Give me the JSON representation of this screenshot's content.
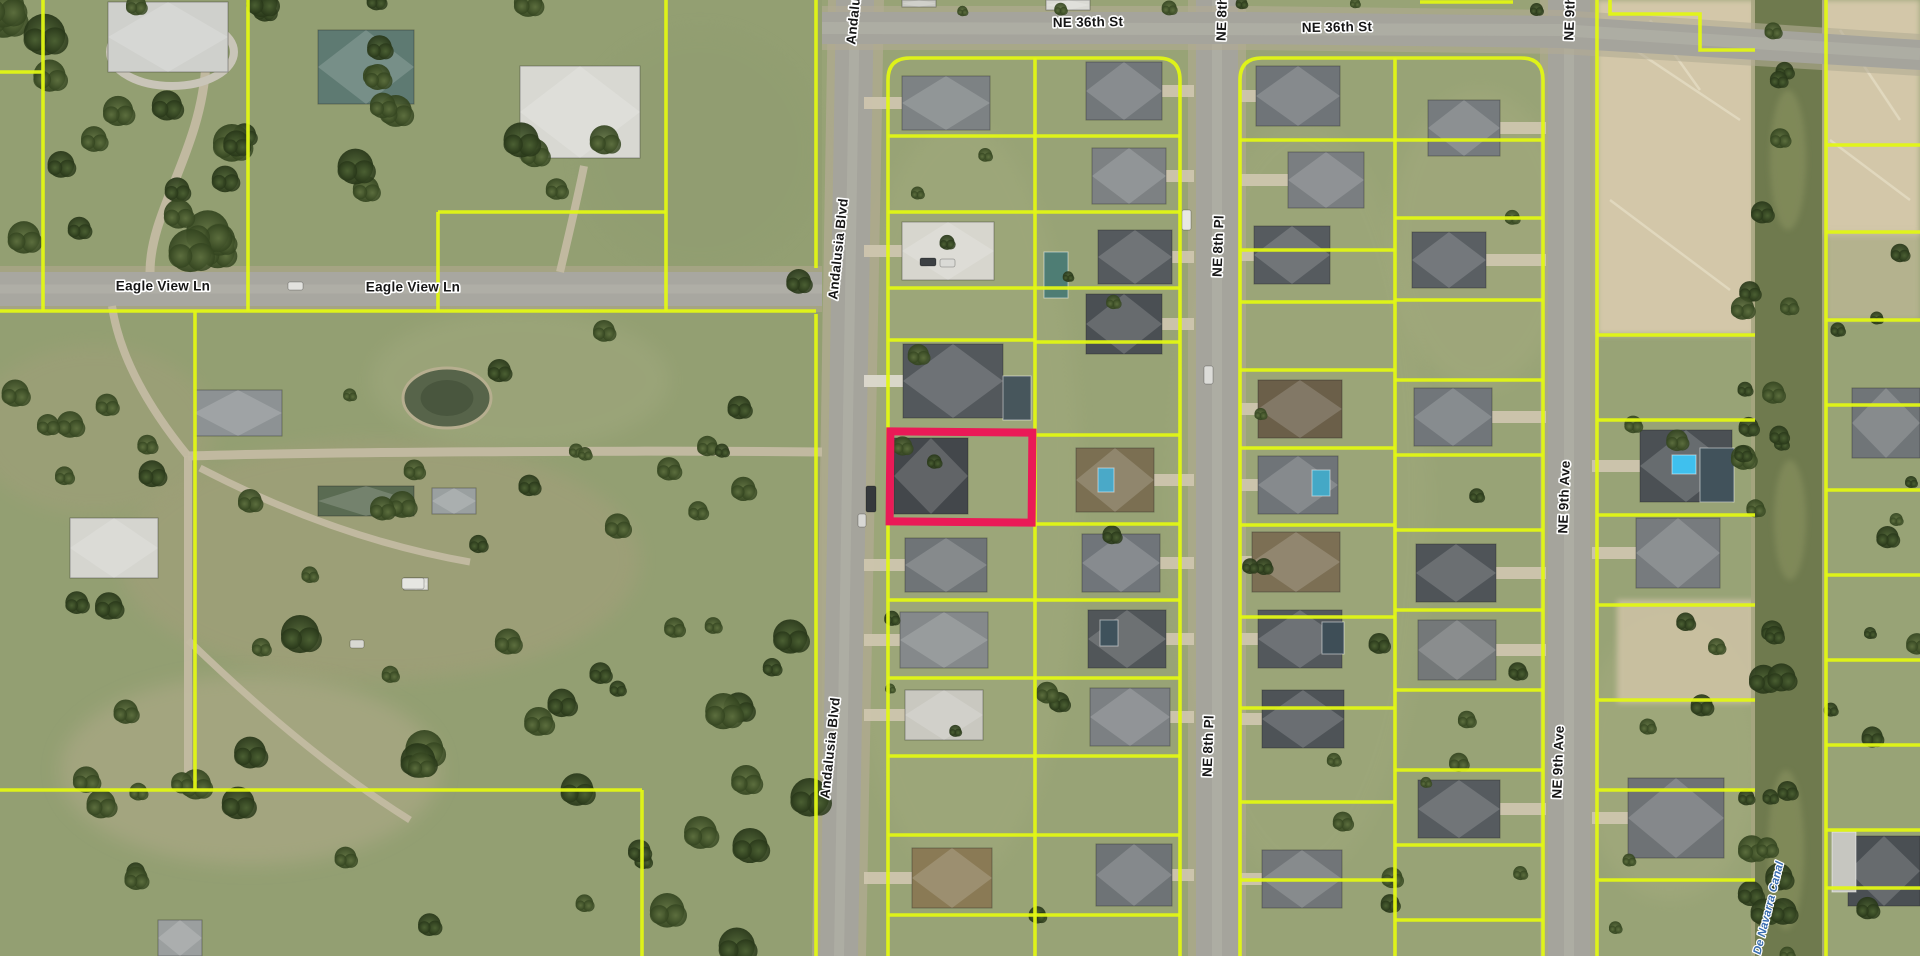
{
  "map": {
    "width": 1920,
    "height": 956,
    "colors": {
      "grass": "#98a376",
      "grass_west_overlay": "#89986b",
      "asphalt": "#a5a49c",
      "asphalt_wear": "#b8b7ae",
      "shoulder": "#b3ab94",
      "dirt": "#d3c7a9",
      "dirt_streak": "#e7dfc8",
      "parcel_line": "#e1f714",
      "highlight": "#ea1a57",
      "water": "#6f7a4e",
      "water_light": "#8a9361",
      "pond": "#57644a",
      "label_fill": "#151515",
      "label_halo": "#ffffff",
      "canal_label_fill": "#3a6db0",
      "driveway": "#c3bba2"
    },
    "street_labels": [
      {
        "text": "Andalusia Blvd",
        "x": 857,
        "y": -6,
        "rot": -84
      },
      {
        "text": "NE 36th St",
        "x": 1088,
        "y": 23,
        "rot": -1
      },
      {
        "text": "NE 8th Pl",
        "x": 1223,
        "y": 10,
        "rot": -88
      },
      {
        "text": "NE 36th St",
        "x": 1337,
        "y": 28,
        "rot": -1
      },
      {
        "text": "NE 9th Ave",
        "x": 1571,
        "y": 4,
        "rot": -88
      },
      {
        "text": "Eagle View Ln",
        "x": 163,
        "y": 287,
        "rot": 0
      },
      {
        "text": "Eagle View Ln",
        "x": 413,
        "y": 288,
        "rot": 0
      },
      {
        "text": "Andalusia Blvd",
        "x": 839,
        "y": 249,
        "rot": -84
      },
      {
        "text": "NE 8th Pl",
        "x": 1219,
        "y": 246,
        "rot": -88
      },
      {
        "text": "NE 9th Ave",
        "x": 1565,
        "y": 497,
        "rot": -88
      },
      {
        "text": "Andalusia Blvd",
        "x": 831,
        "y": 748,
        "rot": -84
      },
      {
        "text": "NE 8th Pl",
        "x": 1209,
        "y": 746,
        "rot": -88
      },
      {
        "text": "NE 9th Ave",
        "x": 1559,
        "y": 762,
        "rot": -88
      }
    ],
    "canal": {
      "label": "De Navarra Canal",
      "x": 1755,
      "w": 67,
      "label_x": 1769,
      "label_y": 908,
      "label_rot": -76,
      "patches": [
        {
          "cx": 1788,
          "cy": 160,
          "rx": 18,
          "ry": 70
        },
        {
          "cx": 1790,
          "cy": 520,
          "rx": 16,
          "ry": 60
        },
        {
          "cx": 1786,
          "cy": 850,
          "rx": 18,
          "ry": 80
        }
      ]
    },
    "roads": {
      "ne36_poly": "822,12 1250,12 1560,16 1920,40 1920,70 1560,48 1250,44 822,44",
      "ne36_shoulder": "822,6 1250,6 1560,10 1920,34 1920,76 1560,54 1250,50 822,50",
      "ne36_center": "M 822,28 L 1560,30 L 1920,54",
      "andalusia_poly": "836,0 874,0 858,956 820,956",
      "andalusia_shoulder": "828,0 884,0 866,956 812,956",
      "andalusia_center": "M 855,0 L 839,956",
      "ne8": {
        "x": 1196,
        "w": 42
      },
      "ne9": {
        "x": 1548,
        "w": 42
      },
      "eagle": {
        "y": 272,
        "h": 34,
        "x2": 822
      }
    },
    "highlight_parcel": {
      "x": 890,
      "y": 432,
      "w": 142,
      "h": 90,
      "stroke_width": 8,
      "rot": 0.5
    },
    "parcel_lines": [
      "M 0,72 L 43,72",
      "M 43,0 L 43,311",
      "M 248,0 L 248,311",
      "M 666,0 L 666,311",
      "M 438,212 L 666,212",
      "M 438,212 L 438,311",
      "M 0,311 L 816,311",
      "M 195,311 L 195,790",
      "M 0,790 L 642,790",
      "M 642,790 L 642,956",
      "M 816,0 L 816,268",
      "M 816,314 L 816,956",
      "M 888,956 L 888,80 Q 888,58 910,58 L 1158,58 Q 1180,58 1180,80 L 1180,956",
      "M 1035,58 L 1035,956",
      "M 888,136 L 1035,136",
      "M 888,212 L 1035,212",
      "M 888,288 L 1035,288",
      "M 888,340 L 1035,340",
      "M 888,600 L 1035,600",
      "M 888,678 L 1035,678",
      "M 888,756 L 1035,756",
      "M 888,835 L 1035,835",
      "M 888,915 L 1035,915",
      "M 1035,136 L 1180,136",
      "M 1035,212 L 1180,212",
      "M 1035,288 L 1180,288",
      "M 1035,342 L 1180,342",
      "M 1035,435 L 1180,435",
      "M 1035,524 L 1180,524",
      "M 1035,600 L 1180,600",
      "M 1035,678 L 1180,678",
      "M 1035,756 L 1180,756",
      "M 1035,835 L 1180,835",
      "M 1035,915 L 1180,915",
      "M 1240,956 L 1240,80 Q 1240,58 1262,58 L 1521,58 Q 1543,58 1543,80 L 1543,956",
      "M 1395,58 L 1395,956",
      "M 1240,140 L 1395,140",
      "M 1240,250 L 1395,250",
      "M 1240,302 L 1395,302",
      "M 1240,370 L 1395,370",
      "M 1240,448 L 1395,448",
      "M 1240,525 L 1395,525",
      "M 1240,617 L 1395,617",
      "M 1240,708 L 1395,708",
      "M 1240,802 L 1395,802",
      "M 1240,880 L 1395,880",
      "M 1395,140 L 1543,140",
      "M 1395,218 L 1543,218",
      "M 1395,300 L 1543,300",
      "M 1395,380 L 1543,380",
      "M 1395,455 L 1543,455",
      "M 1395,530 L 1543,530",
      "M 1395,610 L 1543,610",
      "M 1395,690 L 1543,690",
      "M 1395,770 L 1543,770",
      "M 1395,845 L 1543,845",
      "M 1395,920 L 1543,920",
      "M 1597,0 L 1597,956",
      "M 1610,0 L 1610,14 L 1700,14 L 1700,50 L 1755,50",
      "M 1597,335 L 1755,335",
      "M 1597,420 L 1755,420",
      "M 1597,515 L 1755,515",
      "M 1597,605 L 1755,605",
      "M 1597,700 L 1755,700",
      "M 1597,790 L 1755,790",
      "M 1597,880 L 1755,880",
      "M 1826,0 L 1826,956",
      "M 1826,145 L 1920,145",
      "M 1826,232 L 1920,232",
      "M 1826,320 L 1920,320",
      "M 1826,405 L 1920,405",
      "M 1826,490 L 1920,490",
      "M 1826,575 L 1920,575",
      "M 1826,660 L 1920,660",
      "M 1826,745 L 1920,745",
      "M 1826,830 L 1920,830",
      "M 1826,888 L 1920,888",
      "M 1420,2 L 1513,2"
    ],
    "dirt_areas": [
      {
        "x": 1597,
        "y": 0,
        "w": 158,
        "h": 335,
        "c": "#d3c7a9",
        "o": 1
      },
      {
        "x": 1822,
        "y": 0,
        "w": 98,
        "h": 235,
        "c": "#d3c7a9",
        "o": 1
      },
      {
        "x": 1617,
        "y": 600,
        "w": 138,
        "h": 103,
        "c": "#cdc2a4",
        "o": 0.9
      },
      {
        "x": 1826,
        "y": 232,
        "w": 94,
        "h": 88,
        "c": "#c8bd9f",
        "o": 0.6
      }
    ],
    "dirt_streaks": [
      "M 1620,40 L 1740,120",
      "M 1650,20 L 1700,90",
      "M 1610,200 L 1730,290",
      "M 1840,30 L 1900,120",
      "M 1830,140 L 1910,200"
    ],
    "field_patches": [
      {
        "cx": 380,
        "cy": 560,
        "rx": 260,
        "ry": 120,
        "c": "#a89f7e",
        "o": 0.45
      },
      {
        "cx": 250,
        "cy": 770,
        "rx": 190,
        "ry": 95,
        "c": "#b3ab8c",
        "o": 0.5
      },
      {
        "cx": 95,
        "cy": 430,
        "rx": 120,
        "ry": 85,
        "c": "#a89f7e",
        "o": 0.35
      },
      {
        "cx": 520,
        "cy": 380,
        "rx": 150,
        "ry": 70,
        "c": "#a7ad84",
        "o": 0.35
      },
      {
        "cx": 960,
        "cy": 500,
        "rx": 120,
        "ry": 380,
        "c": "#aab083",
        "o": 0.25
      },
      {
        "cx": 1300,
        "cy": 500,
        "rx": 130,
        "ry": 380,
        "c": "#a9af82",
        "o": 0.22
      },
      {
        "cx": 1480,
        "cy": 240,
        "rx": 90,
        "ry": 150,
        "c": "#b0b286",
        "o": 0.25
      },
      {
        "cx": 1670,
        "cy": 760,
        "rx": 90,
        "ry": 140,
        "c": "#aeb184",
        "o": 0.3
      },
      {
        "cx": 700,
        "cy": 150,
        "rx": 120,
        "ry": 120,
        "c": "#8f9c6f",
        "o": 0.4
      }
    ],
    "pond": {
      "cx": 447,
      "cy": 398,
      "rx": 44,
      "ry": 30
    },
    "drive_paths": [
      {
        "d": "M 822,452 C 620,450 320,452 188,456",
        "w": 9
      },
      {
        "d": "M 188,456 L 188,788",
        "w": 8
      },
      {
        "d": "M 112,306 C 120,360 152,412 188,456",
        "w": 8
      },
      {
        "d": "M 200,468 C 300,520 390,548 470,562",
        "w": 7
      },
      {
        "d": "M 150,272 C 150,210 202,150 206,62",
        "w": 9
      },
      {
        "d": "M 560,272 C 570,230 578,196 584,166",
        "w": 8
      },
      {
        "d": "M 188,640 C 250,700 330,770 410,820",
        "w": 7
      }
    ],
    "estate_ring": {
      "cx": 172,
      "cy": 52,
      "rx": 62,
      "ry": 34
    },
    "houses": [
      {
        "x": 902,
        "y": 76,
        "w": 88,
        "h": 54,
        "c": "#7d8284",
        "drive": 864
      },
      {
        "x": 902,
        "y": 222,
        "w": 92,
        "h": 58,
        "c": "#d7d6ce",
        "drive": 864
      },
      {
        "x": 903,
        "y": 344,
        "w": 100,
        "h": 74,
        "c": "#53585c",
        "drive": 864,
        "dc": "#dcd9ce"
      },
      {
        "x": 894,
        "y": 438,
        "w": 74,
        "h": 76,
        "c": "#43474b"
      },
      {
        "x": 905,
        "y": 538,
        "w": 82,
        "h": 54,
        "c": "#6f7477",
        "drive": 864
      },
      {
        "x": 900,
        "y": 612,
        "w": 88,
        "h": 56,
        "c": "#85898b",
        "drive": 864
      },
      {
        "x": 905,
        "y": 690,
        "w": 78,
        "h": 50,
        "c": "#c9c8c0",
        "drive": 864
      },
      {
        "x": 912,
        "y": 848,
        "w": 80,
        "h": 60,
        "c": "#8a7a55",
        "drive": 864
      },
      {
        "x": 1086,
        "y": 62,
        "w": 76,
        "h": 58,
        "c": "#72777a",
        "drive": 1194
      },
      {
        "x": 1092,
        "y": 148,
        "w": 74,
        "h": 56,
        "c": "#7d8183",
        "drive": 1194
      },
      {
        "x": 1098,
        "y": 230,
        "w": 74,
        "h": 54,
        "c": "#555a5e",
        "drive": 1194
      },
      {
        "x": 1086,
        "y": 294,
        "w": 76,
        "h": 60,
        "c": "#4a4f53",
        "drive": 1194
      },
      {
        "x": 1076,
        "y": 448,
        "w": 78,
        "h": 64,
        "c": "#7b6f52",
        "drive": 1194
      },
      {
        "x": 1082,
        "y": 534,
        "w": 78,
        "h": 58,
        "c": "#70757a",
        "drive": 1194
      },
      {
        "x": 1088,
        "y": 610,
        "w": 78,
        "h": 58,
        "c": "#515659",
        "drive": 1194
      },
      {
        "x": 1090,
        "y": 688,
        "w": 80,
        "h": 58,
        "c": "#7c8083",
        "drive": 1194
      },
      {
        "x": 1096,
        "y": 844,
        "w": 76,
        "h": 62,
        "c": "#6e7376",
        "drive": 1194
      },
      {
        "x": 1256,
        "y": 66,
        "w": 84,
        "h": 60,
        "c": "#6f7478",
        "drive": 1240
      },
      {
        "x": 1288,
        "y": 152,
        "w": 76,
        "h": 56,
        "c": "#7a7e81",
        "drive": 1240
      },
      {
        "x": 1254,
        "y": 226,
        "w": 76,
        "h": 58,
        "c": "#565b5f",
        "drive": 1240
      },
      {
        "x": 1258,
        "y": 380,
        "w": 84,
        "h": 58,
        "c": "#6b5f49",
        "drive": 1240
      },
      {
        "x": 1258,
        "y": 456,
        "w": 80,
        "h": 58,
        "c": "#6f7478",
        "drive": 1240
      },
      {
        "x": 1252,
        "y": 532,
        "w": 88,
        "h": 60,
        "c": "#7c6f54",
        "drive": 1240
      },
      {
        "x": 1258,
        "y": 610,
        "w": 84,
        "h": 58,
        "c": "#53585c",
        "drive": 1240
      },
      {
        "x": 1262,
        "y": 690,
        "w": 82,
        "h": 58,
        "c": "#4e5357",
        "drive": 1240
      },
      {
        "x": 1262,
        "y": 850,
        "w": 80,
        "h": 58,
        "c": "#717578",
        "drive": 1240
      },
      {
        "x": 1428,
        "y": 100,
        "w": 72,
        "h": 56,
        "c": "#767b7e",
        "drive": 1546
      },
      {
        "x": 1412,
        "y": 232,
        "w": 74,
        "h": 56,
        "c": "#5a5f63",
        "drive": 1546
      },
      {
        "x": 1414,
        "y": 388,
        "w": 78,
        "h": 58,
        "c": "#71767a",
        "drive": 1546
      },
      {
        "x": 1416,
        "y": 544,
        "w": 80,
        "h": 58,
        "c": "#4f5458",
        "drive": 1546
      },
      {
        "x": 1418,
        "y": 620,
        "w": 78,
        "h": 60,
        "c": "#747879",
        "drive": 1546
      },
      {
        "x": 1418,
        "y": 780,
        "w": 82,
        "h": 58,
        "c": "#565b5f",
        "drive": 1546
      },
      {
        "x": 1640,
        "y": 430,
        "w": 92,
        "h": 72,
        "c": "#4b5054",
        "drive": 1592
      },
      {
        "x": 1636,
        "y": 518,
        "w": 84,
        "h": 70,
        "c": "#777b7e",
        "drive": 1592
      },
      {
        "x": 1628,
        "y": 778,
        "w": 96,
        "h": 80,
        "c": "#6e7275",
        "drive": 1592
      },
      {
        "x": 1852,
        "y": 388,
        "w": 68,
        "h": 70,
        "c": "#707578",
        "drive": 1920
      },
      {
        "x": 1848,
        "y": 836,
        "w": 72,
        "h": 70,
        "c": "#4a4f53",
        "drive": 1920
      },
      {
        "x": 108,
        "y": 2,
        "w": 120,
        "h": 70,
        "c": "#cfd0cc"
      },
      {
        "x": 318,
        "y": 30,
        "w": 96,
        "h": 74,
        "c": "#5e7a72"
      },
      {
        "x": 520,
        "y": 66,
        "w": 120,
        "h": 92,
        "c": "#d8d8d2"
      },
      {
        "x": 194,
        "y": 390,
        "w": 88,
        "h": 46,
        "c": "#8d9294"
      },
      {
        "x": 70,
        "y": 518,
        "w": 88,
        "h": 60,
        "c": "#d5d5cf"
      },
      {
        "x": 318,
        "y": 486,
        "w": 96,
        "h": 30,
        "c": "#5a6b52"
      },
      {
        "x": 432,
        "y": 488,
        "w": 44,
        "h": 26,
        "c": "#9aa0a0"
      },
      {
        "x": 158,
        "y": 920,
        "w": 44,
        "h": 36,
        "c": "#9b9f9f"
      },
      {
        "x": 404,
        "y": 578,
        "w": 24,
        "h": 12,
        "c": "#e0e0da"
      },
      {
        "x": 1046,
        "y": 0,
        "w": 44,
        "h": 10,
        "c": "#dadad4"
      },
      {
        "x": 902,
        "y": 0,
        "w": 34,
        "h": 7,
        "c": "#c8c8c2"
      }
    ],
    "pools": [
      {
        "x": 1003,
        "y": 376,
        "w": 28,
        "h": 44,
        "c": "#47565c"
      },
      {
        "x": 1044,
        "y": 252,
        "w": 24,
        "h": 46,
        "c": "#4e7d74"
      },
      {
        "x": 1098,
        "y": 468,
        "w": 16,
        "h": 24,
        "c": "#4aa9c8"
      },
      {
        "x": 1100,
        "y": 620,
        "w": 18,
        "h": 26,
        "c": "#3f525c"
      },
      {
        "x": 1312,
        "y": 470,
        "w": 18,
        "h": 26,
        "c": "#44a8c6"
      },
      {
        "x": 1322,
        "y": 622,
        "w": 22,
        "h": 32,
        "c": "#3e4e57"
      },
      {
        "x": 1672,
        "y": 455,
        "w": 24,
        "h": 19,
        "c": "#3fc0ee"
      },
      {
        "x": 1700,
        "y": 448,
        "w": 34,
        "h": 54,
        "c": "#41525b"
      },
      {
        "x": 1832,
        "y": 832,
        "w": 24,
        "h": 60,
        "c": "#c6c6c0"
      }
    ],
    "cars": [
      {
        "x": 1182,
        "y": 210,
        "w": 9,
        "h": 20,
        "c": "#e8e8e4"
      },
      {
        "x": 920,
        "y": 258,
        "w": 16,
        "h": 8,
        "c": "#3c4043"
      },
      {
        "x": 940,
        "y": 259,
        "w": 15,
        "h": 8,
        "c": "#dadad6"
      },
      {
        "x": 866,
        "y": 486,
        "w": 10,
        "h": 26,
        "c": "#35393c"
      },
      {
        "x": 858,
        "y": 514,
        "w": 8,
        "h": 13,
        "c": "#d8d8d4"
      },
      {
        "x": 288,
        "y": 282,
        "w": 15,
        "h": 8,
        "c": "#e2e2de"
      },
      {
        "x": 1204,
        "y": 366,
        "w": 9,
        "h": 18,
        "c": "#dcdcd8"
      },
      {
        "x": 402,
        "y": 578,
        "w": 22,
        "h": 11,
        "c": "#e6e6e2"
      },
      {
        "x": 350,
        "y": 640,
        "w": 14,
        "h": 8,
        "c": "#d8d8d2"
      }
    ],
    "tree_zones": [
      {
        "x": 0,
        "y": 0,
        "w": 320,
        "h": 260,
        "n": 24,
        "a": 9,
        "b": 22
      },
      {
        "x": 320,
        "y": 0,
        "w": 330,
        "h": 190,
        "n": 13,
        "a": 8,
        "b": 18
      },
      {
        "x": 0,
        "y": 320,
        "w": 190,
        "h": 290,
        "n": 9,
        "a": 7,
        "b": 15
      },
      {
        "x": 210,
        "y": 330,
        "w": 440,
        "h": 250,
        "n": 11,
        "a": 6,
        "b": 14
      },
      {
        "x": 0,
        "y": 615,
        "w": 810,
        "h": 341,
        "n": 40,
        "a": 8,
        "b": 20
      },
      {
        "x": 560,
        "y": 200,
        "w": 240,
        "h": 400,
        "n": 9,
        "a": 6,
        "b": 13
      },
      {
        "x": 890,
        "y": 60,
        "w": 290,
        "h": 880,
        "n": 15,
        "a": 5,
        "b": 11
      },
      {
        "x": 1246,
        "y": 60,
        "w": 290,
        "h": 880,
        "n": 15,
        "a": 5,
        "b": 11
      },
      {
        "x": 1600,
        "y": 335,
        "w": 150,
        "h": 610,
        "n": 9,
        "a": 6,
        "b": 12
      },
      {
        "x": 1738,
        "y": 0,
        "w": 52,
        "h": 956,
        "n": 30,
        "a": 7,
        "b": 15
      },
      {
        "x": 1824,
        "y": 240,
        "w": 94,
        "h": 700,
        "n": 11,
        "a": 6,
        "b": 12
      },
      {
        "x": 840,
        "y": 0,
        "w": 700,
        "h": 12,
        "n": 6,
        "a": 4,
        "b": 8
      }
    ]
  }
}
